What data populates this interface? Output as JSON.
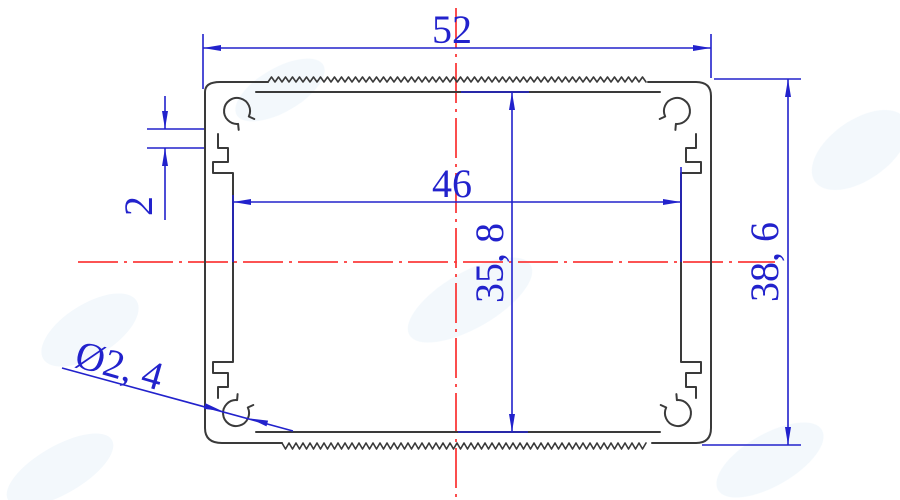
{
  "title": "aluminum-extrusion-profile-cross-section-drawing",
  "dims": {
    "outer_width": {
      "label": "52"
    },
    "inner_width": {
      "label": "46"
    },
    "inner_height": {
      "label": "35, 8"
    },
    "outer_height": {
      "label": "38, 6"
    },
    "slot_step": {
      "label": "2"
    },
    "hole_diameter": {
      "label": "Ø2, 4"
    }
  },
  "colors": {
    "dimension": "#2222cc",
    "centerline": "#fb3b3b",
    "outline": "#3a3a3a",
    "watermark": "#e9f3fa",
    "background": "#ffffff"
  }
}
